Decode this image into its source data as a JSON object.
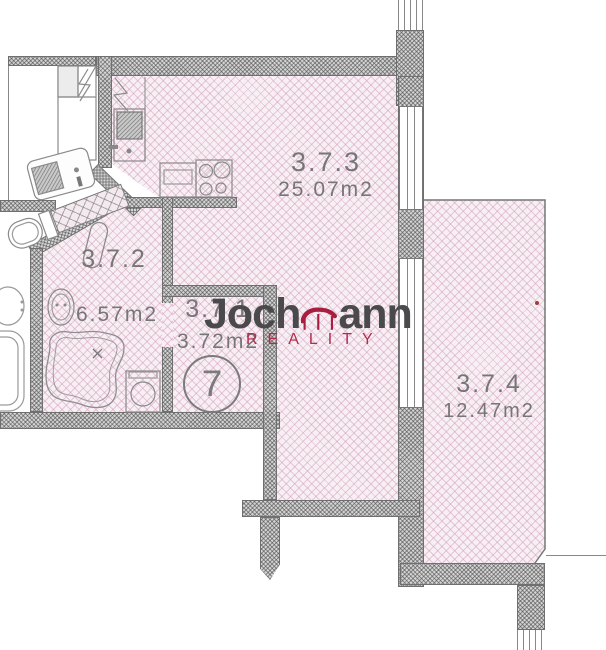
{
  "plan": {
    "rooms": [
      {
        "number": "3.7.3",
        "area": "25.07m2"
      },
      {
        "number": "3.7.2",
        "area": "6.57m2"
      },
      {
        "number": "3.7.1",
        "area": "3.72m2"
      },
      {
        "number": "3.7.4",
        "area": "12.47m2"
      }
    ],
    "unit_badge": "7"
  },
  "watermark": {
    "brand_left": "Joch",
    "brand_right": "ann",
    "subtitle": "REALITY"
  },
  "colors": {
    "room_fill": "#f8eff4",
    "room_hatch": "#cb94b2",
    "wall_fill": "#d4d4d4",
    "brand_dark": "#4a4a4c",
    "brand_red": "#a81e3e",
    "subtitle_red": "#b62b4d"
  }
}
